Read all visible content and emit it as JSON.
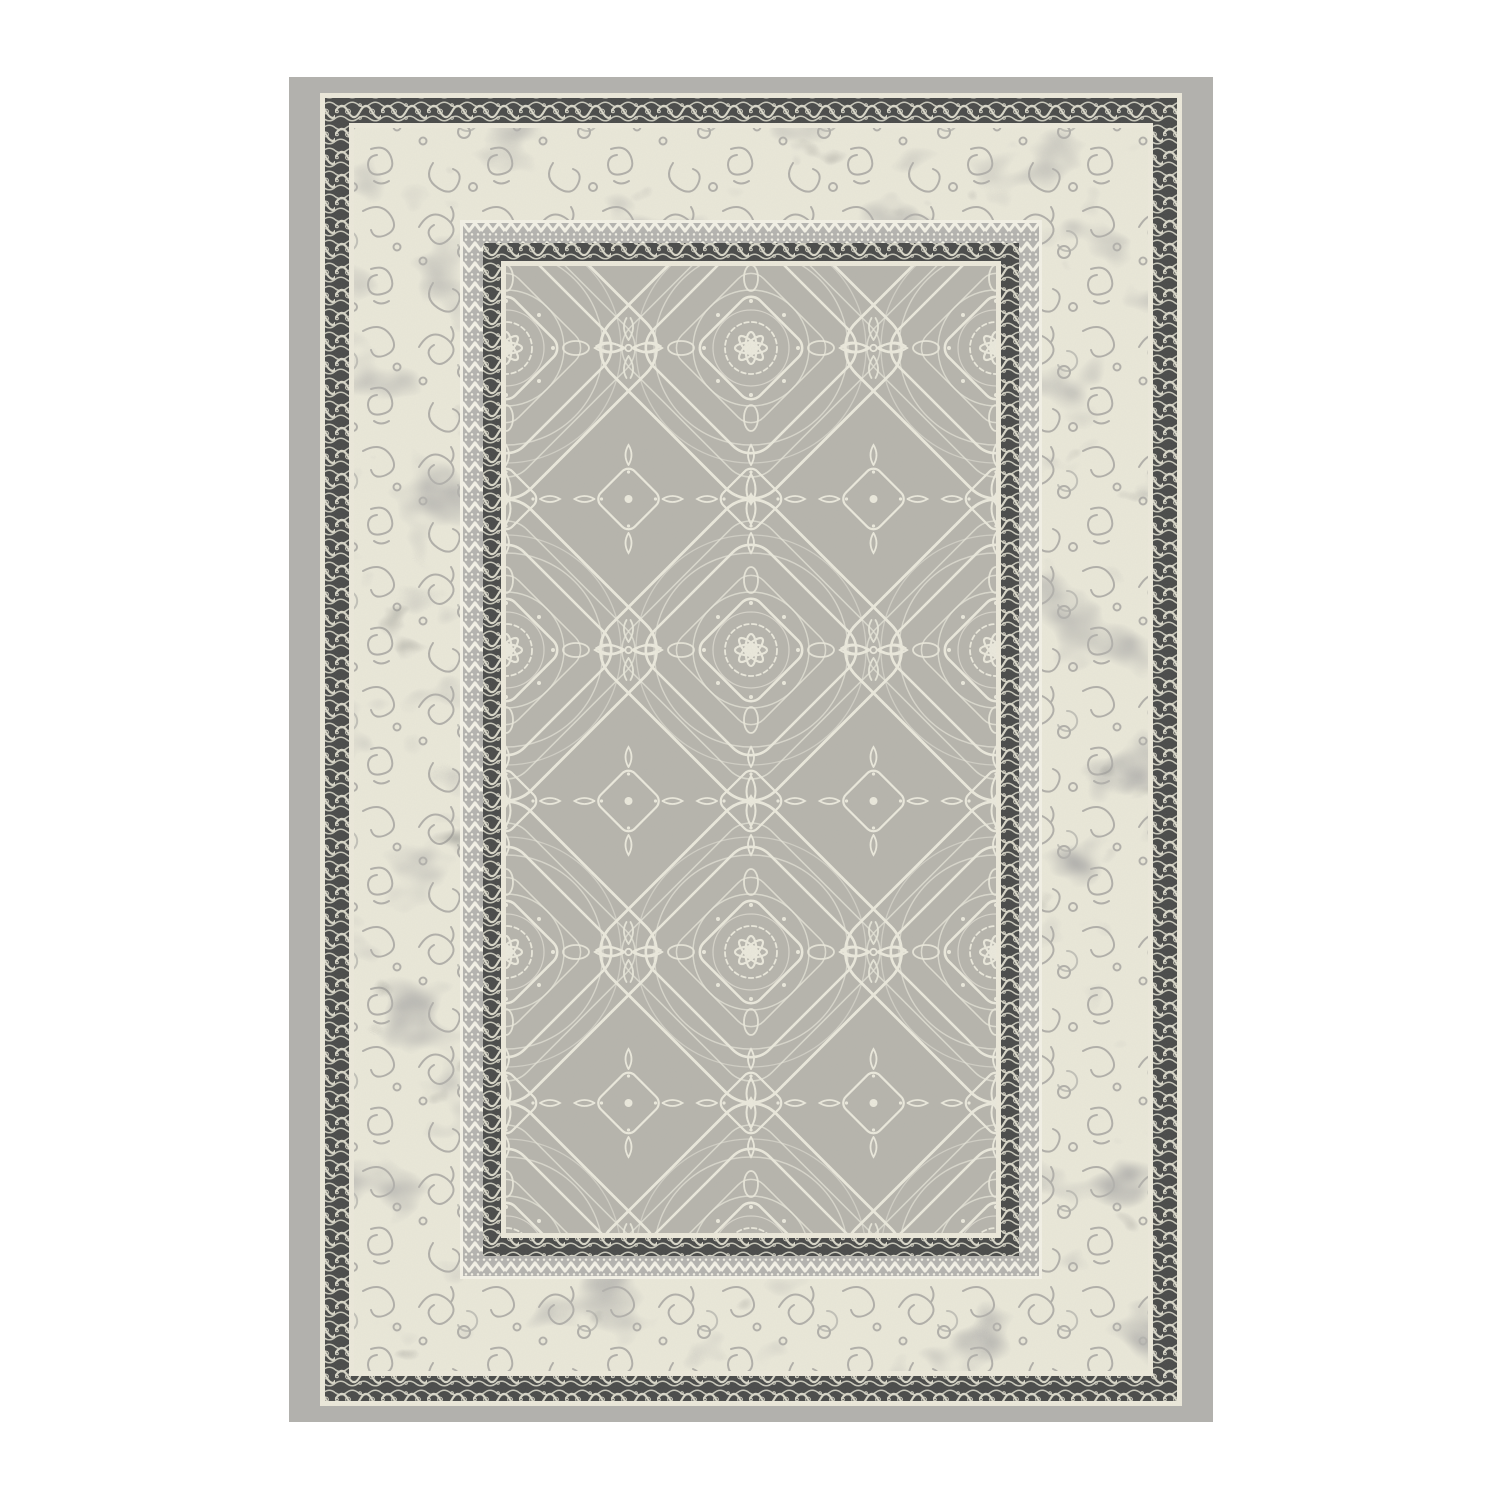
{
  "image": {
    "description": "Product photo of a rectangular grey oriental-style area rug with an ornate arabesque medallion field, a distressed ivory band and dark scrollwork borders, on a plain white background",
    "width_px": 1500,
    "height_px": 1500
  },
  "colors": {
    "page_bg": "#ffffff",
    "border_gray": "#b2b1ad",
    "cream": "#ebe8da",
    "charcoal": "#4a4b4a",
    "frieze_motif": "#d8d6c8",
    "mottled_base": "#e9e7d8",
    "mottled_scroll": "#a2a19d",
    "blotch_light": "#b3b2ae",
    "blotch_mid": "#94948f",
    "blotch_dark": "#5e5f5d",
    "field_gray": "#b6b4ac",
    "field_line": "#eceadd",
    "zigzag_bg": "#b4b3af",
    "zigzag_line": "#f2f0e5"
  }
}
